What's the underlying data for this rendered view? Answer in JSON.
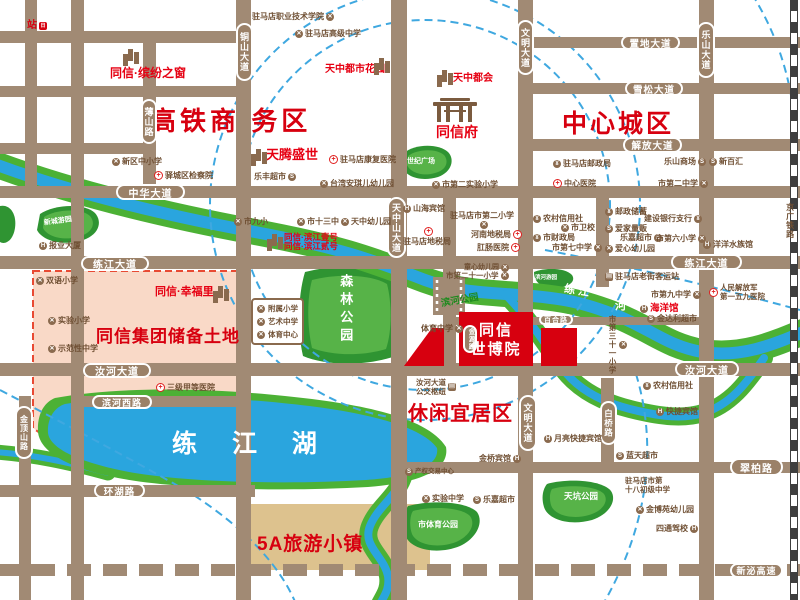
{
  "colors": {
    "road": "#a18a74",
    "capsule": "#9b8168",
    "red_accent": "#d7000f",
    "project_red": "#e60012",
    "park_green": "#2f9432",
    "park_green_light": "#57b348",
    "water_blue": "#2aa5de",
    "river_green": "#4cb135",
    "pink_zone": "#f9d9c7",
    "tan_block": "#ddc28e",
    "poi_brown": "#6f4f33",
    "arc_blue": "#3fa8e0"
  },
  "zones": [
    {
      "name": "zone-hsr-business",
      "text": "高铁商 务区",
      "x": 150,
      "y": 101,
      "size": 26,
      "ls": 4
    },
    {
      "name": "zone-central-city",
      "text": "中心城区",
      "x": 562,
      "y": 104,
      "size": 25,
      "ls": 3
    },
    {
      "name": "zone-reserve-land",
      "text": "同信集团储备土地",
      "x": 96,
      "y": 322,
      "size": 17,
      "ls": 1
    },
    {
      "name": "zone-leisure-area",
      "text": "休闲宜居区",
      "x": 408,
      "y": 397,
      "size": 20,
      "ls": 1
    },
    {
      "name": "zone-5a-town",
      "text": "5A旅游小镇",
      "x": 257,
      "y": 529,
      "size": 19,
      "ls": 1
    },
    {
      "name": "zone-lianjiang-lake",
      "text": "练 江 湖",
      "x": 172,
      "y": 424,
      "size": 25,
      "ls": 14,
      "color": "#ffffff"
    }
  ],
  "capsules": [
    {
      "name": "road-tongshan-avenue",
      "text": "铜山大道",
      "x": 236,
      "y": 23,
      "w": 17,
      "h": 58,
      "v": true,
      "size": 9
    },
    {
      "name": "road-boshan-road",
      "text": "薄山路",
      "x": 141,
      "y": 99,
      "w": 16,
      "h": 45,
      "v": true,
      "size": 9
    },
    {
      "name": "road-wenming-avenue-n",
      "text": "文明大道",
      "x": 517,
      "y": 20,
      "w": 17,
      "h": 55,
      "v": true,
      "size": 9
    },
    {
      "name": "road-leshan-avenue",
      "text": "乐山大道",
      "x": 697,
      "y": 22,
      "w": 18,
      "h": 56,
      "v": true,
      "size": 9
    },
    {
      "name": "road-zhidi-avenue",
      "text": "置地大道",
      "x": 621,
      "y": 35,
      "w": 59,
      "h": 15,
      "size": 9.5
    },
    {
      "name": "road-xuesong-avenue",
      "text": "雪松大道",
      "x": 625,
      "y": 81,
      "w": 58,
      "h": 15,
      "size": 9.5
    },
    {
      "name": "road-jiefang-avenue",
      "text": "解放大道",
      "x": 623,
      "y": 137,
      "w": 59,
      "h": 16,
      "size": 9.5
    },
    {
      "name": "road-zhonghua-avenue",
      "text": "中华大道",
      "x": 116,
      "y": 184,
      "w": 69,
      "h": 16,
      "size": 10
    },
    {
      "name": "road-lianjiang-avenue-w",
      "text": "练江大道",
      "x": 81,
      "y": 256,
      "w": 68,
      "h": 15,
      "size": 10
    },
    {
      "name": "road-lianjiang-avenue-e",
      "text": "练江大道",
      "x": 671,
      "y": 254,
      "w": 71,
      "h": 16,
      "size": 10
    },
    {
      "name": "road-tianzhongshan-avenue",
      "text": "天中山大道",
      "x": 387,
      "y": 197,
      "w": 19,
      "h": 61,
      "v": true,
      "size": 9
    },
    {
      "name": "road-ruhe-avenue-w",
      "text": "汝河大道",
      "x": 83,
      "y": 363,
      "w": 68,
      "h": 15,
      "size": 10
    },
    {
      "name": "road-ruhe-avenue-e",
      "text": "汝河大道",
      "x": 675,
      "y": 361,
      "w": 64,
      "h": 16,
      "size": 10
    },
    {
      "name": "road-binhe-west-road",
      "text": "滨河西路",
      "x": 92,
      "y": 395,
      "w": 60,
      "h": 14,
      "size": 9
    },
    {
      "name": "road-jindingshan-road",
      "text": "金顶山路",
      "x": 15,
      "y": 406,
      "w": 18,
      "h": 53,
      "v": true,
      "size": 8
    },
    {
      "name": "road-huanhu-road",
      "text": "环湖路",
      "x": 94,
      "y": 483,
      "w": 51,
      "h": 15,
      "size": 9.5
    },
    {
      "name": "road-wenming-avenue-s",
      "text": "文明大道",
      "x": 519,
      "y": 395,
      "w": 18,
      "h": 56,
      "v": true,
      "size": 9
    },
    {
      "name": "road-baiqiao-road",
      "text": "白桥路",
      "x": 600,
      "y": 401,
      "w": 17,
      "h": 44,
      "v": true,
      "size": 8.5
    },
    {
      "name": "road-cuibai-road",
      "text": "翠柏路",
      "x": 730,
      "y": 458,
      "w": 53,
      "h": 18,
      "size": 10
    },
    {
      "name": "road-xinmi-expressway",
      "text": "新泌高速",
      "x": 730,
      "y": 563,
      "w": 53,
      "h": 15,
      "size": 9
    },
    {
      "name": "road-baihe-road",
      "text": "百合路",
      "x": 539,
      "y": 314,
      "w": 34,
      "h": 11,
      "size": 7
    },
    {
      "name": "road-jinyuan-road",
      "text": "金源路",
      "x": 463,
      "y": 325,
      "w": 14,
      "h": 28,
      "v": true,
      "size": 6.5
    }
  ],
  "parklabels": [
    {
      "name": "park-century-square",
      "text": "世纪广场",
      "x": 407,
      "y": 158,
      "size": 7
    },
    {
      "name": "park-xincheng-garden",
      "text": "新城游园",
      "x": 44,
      "y": 218,
      "size": 7,
      "rot": -8
    },
    {
      "name": "park-forest-park",
      "text": "森林公园",
      "x": 338,
      "y": 274,
      "size": 13,
      "v": true,
      "ls": 5
    },
    {
      "name": "park-binhe-park",
      "text": "滨河公园",
      "x": 441,
      "y": 296,
      "size": 9.5,
      "rot": -10,
      "color": "#1e8a1e"
    },
    {
      "name": "park-binhe-garden",
      "text": "滨河游园",
      "x": 535,
      "y": 275,
      "size": 5.5
    },
    {
      "name": "park-city-sports-park",
      "text": "市体育公园",
      "x": 418,
      "y": 521,
      "size": 8
    },
    {
      "name": "park-tiankeng-park",
      "text": "天坑公园",
      "x": 564,
      "y": 492,
      "size": 8.5
    },
    {
      "name": "river-lianjiang",
      "text": "练  江",
      "x": 564,
      "y": 285,
      "size": 11,
      "rot": 9
    },
    {
      "name": "river-he",
      "text": "河",
      "x": 615,
      "y": 300,
      "size": 11
    }
  ],
  "projects": [
    {
      "name": "proj-binfenzhichuang",
      "text": "同信·缤纷之窗",
      "x": 110,
      "y": 67,
      "size": 12
    },
    {
      "name": "proj-tianzhong-city-garden",
      "text": "天中都市花园",
      "x": 325,
      "y": 64,
      "size": 10
    },
    {
      "name": "proj-tianzhong-duhui",
      "text": "天中都会",
      "x": 453,
      "y": 73,
      "size": 10
    },
    {
      "name": "proj-tongxin-fu",
      "text": "同信府",
      "x": 436,
      "y": 124,
      "size": 14
    },
    {
      "name": "proj-tianteng-shengshi",
      "text": "天腾盛世",
      "x": 266,
      "y": 148,
      "size": 13
    },
    {
      "name": "proj-binjiang-no1",
      "text": "同信·滨江壹号",
      "x": 284,
      "y": 233,
      "size": 8.5
    },
    {
      "name": "proj-binjiang-no2",
      "text": "同信·滨江贰号",
      "x": 284,
      "y": 242,
      "size": 8.5
    },
    {
      "name": "proj-xingfuli",
      "text": "同信·幸福里",
      "x": 155,
      "y": 286,
      "size": 11
    }
  ],
  "pois": [
    {
      "name": "poi-hsr-station",
      "text": "站",
      "icon": "train",
      "iconAfter": true,
      "x": 27,
      "y": 20,
      "size": 10,
      "color": "#d7000f"
    },
    {
      "name": "poi-xinqu-school",
      "text": "新区中小学",
      "icon": "school",
      "x": 112,
      "y": 157
    },
    {
      "name": "poi-yicheng-procuratorate",
      "text": "驿城区检察院",
      "icon": "red",
      "x": 154,
      "y": 171
    },
    {
      "name": "poi-vocational-college",
      "text": "驻马店职业技术学院",
      "icon": "school",
      "iconAfter": true,
      "x": 252,
      "y": 12
    },
    {
      "name": "poi-senior-high",
      "text": "驻马店高级中学",
      "icon": "school",
      "x": 295,
      "y": 29
    },
    {
      "name": "poi-rehab-hospital",
      "text": "驻马店康复医院",
      "icon": "red",
      "x": 329,
      "y": 155
    },
    {
      "name": "poi-lefeng-market",
      "text": "乐丰超市",
      "icon": "shop",
      "iconAfter": true,
      "x": 254,
      "y": 172
    },
    {
      "name": "poi-taiwan-kindergarten",
      "text": "台湾安琪儿幼儿园",
      "icon": "school",
      "x": 320,
      "y": 179
    },
    {
      "name": "poi-no2-experimental-primary",
      "text": "市第二实验小学",
      "icon": "school",
      "x": 432,
      "y": 180
    },
    {
      "name": "poi-post-office",
      "text": "驻马店邮政局",
      "icon": "bank",
      "x": 553,
      "y": 159
    },
    {
      "name": "poi-central-hospital",
      "text": "中心医院",
      "icon": "red",
      "x": 553,
      "y": 179
    },
    {
      "name": "poi-leshan-mall",
      "text": "乐山商场",
      "icon": "shop",
      "iconAfter": true,
      "x": 664,
      "y": 157
    },
    {
      "name": "poi-xinbaihui",
      "text": "新百汇",
      "icon": "shop",
      "x": 709,
      "y": 157
    },
    {
      "name": "poi-no2-middle-school",
      "text": "市第二中学",
      "icon": "school",
      "iconAfter": true,
      "x": 658,
      "y": 179
    },
    {
      "name": "poi-shanhai-hotel",
      "text": "山海宾馆",
      "icon": "hotel",
      "x": 403,
      "y": 204
    },
    {
      "name": "poi-no2-primary",
      "text": "驻马店市第二小学",
      "x": 450,
      "y": 211
    },
    {
      "name": "poi-no2-primary-icon",
      "text": "",
      "icon": "school",
      "x": 480,
      "y": 221
    },
    {
      "name": "poi-city-tax-bureau",
      "text": "驻马店地税局",
      "x": 403,
      "y": 237
    },
    {
      "name": "poi-city-tax-icon",
      "text": "",
      "icon": "red",
      "x": 424,
      "y": 227
    },
    {
      "name": "poi-henan-tax",
      "text": "河南地税局",
      "icon": "red",
      "iconAfter": true,
      "x": 471,
      "y": 230
    },
    {
      "name": "poi-gangchang-hospital",
      "text": "肛肠医院",
      "icon": "red",
      "iconAfter": true,
      "x": 477,
      "y": 243
    },
    {
      "name": "poi-rural-credit-n",
      "text": "农村信用社",
      "icon": "bank",
      "x": 533,
      "y": 214
    },
    {
      "name": "poi-health-school",
      "text": "市卫校",
      "icon": "school",
      "x": 561,
      "y": 223
    },
    {
      "name": "poi-finance-bureau",
      "text": "市财政局",
      "icon": "bank",
      "x": 533,
      "y": 233
    },
    {
      "name": "poi-no7-middle",
      "text": "市第七中学",
      "icon": "school",
      "iconAfter": true,
      "x": 552,
      "y": 243
    },
    {
      "name": "poi-postal-savings",
      "text": "邮政储蓄",
      "icon": "bank",
      "x": 605,
      "y": 207
    },
    {
      "name": "poi-ccb-branch",
      "text": "建设银行支行",
      "icon": "bank",
      "iconAfter": true,
      "x": 644,
      "y": 214
    },
    {
      "name": "poi-aijia-store",
      "text": "爱家量贩",
      "icon": "shop",
      "x": 605,
      "y": 224
    },
    {
      "name": "poi-lejia-market-n",
      "text": "乐嘉超市",
      "icon": "shop",
      "iconAfter": true,
      "x": 620,
      "y": 233
    },
    {
      "name": "poi-no6-primary",
      "text": "市第六小学",
      "icon": "school",
      "iconAfter": true,
      "x": 656,
      "y": 234
    },
    {
      "name": "poi-aixin-kindergarten",
      "text": "爱心幼儿园",
      "icon": "school",
      "x": 605,
      "y": 244
    },
    {
      "name": "poi-yangyang-aquarium",
      "text": "洋洋水族馆",
      "icon": "hotel",
      "x": 703,
      "y": 240
    },
    {
      "name": "poi-no9-primary",
      "text": "市九小",
      "icon": "school",
      "x": 234,
      "y": 217
    },
    {
      "name": "poi-no13-middle",
      "text": "市十三中",
      "icon": "school",
      "x": 297,
      "y": 217
    },
    {
      "name": "poi-tianzhong-kindergarten",
      "text": "天中幼儿园",
      "icon": "school",
      "x": 341,
      "y": 217
    },
    {
      "name": "poi-press-building",
      "text": "报业大厦",
      "icon": "hotel",
      "x": 39,
      "y": 241
    },
    {
      "name": "poi-bilingual-primary",
      "text": "双语小学",
      "icon": "school",
      "x": 36,
      "y": 276
    },
    {
      "name": "poi-experimental-primary",
      "text": "实验小学",
      "icon": "school",
      "x": 48,
      "y": 316
    },
    {
      "name": "poi-model-middle",
      "text": "示范性中学",
      "icon": "school",
      "x": 48,
      "y": 344
    },
    {
      "name": "poi-3a-hospital",
      "text": "三级甲等医院",
      "icon": "red",
      "x": 156,
      "y": 383
    },
    {
      "name": "poi-tongxin-kindergarten",
      "text": "童心幼儿园",
      "icon": "school",
      "iconAfter": true,
      "x": 464,
      "y": 264,
      "size": 7
    },
    {
      "name": "poi-no21-primary",
      "text": "市第二十一小学",
      "icon": "school",
      "iconAfter": true,
      "x": 446,
      "y": 271,
      "size": 7.5
    },
    {
      "name": "poi-sports-middle",
      "text": "体育中学",
      "icon": "school",
      "iconAfter": true,
      "x": 421,
      "y": 324
    },
    {
      "name": "poi-no31-primary",
      "text": "市第三十一小学",
      "icon": "school",
      "x": 608,
      "y": 315,
      "v": true,
      "size": 7.5
    },
    {
      "name": "poi-laojie-bus-station",
      "text": "驻马店老街客运站",
      "icon": "bus",
      "x": 605,
      "y": 272
    },
    {
      "name": "poi-no9-middle",
      "text": "市第九中学",
      "icon": "school",
      "iconAfter": true,
      "x": 651,
      "y": 290
    },
    {
      "name": "poi-ocean-hall",
      "text": "海洋馆",
      "icon": "hotel",
      "x": 640,
      "y": 303,
      "size": 9.5,
      "color": "#e60012"
    },
    {
      "name": "poi-jindali-market",
      "text": "金达利超市",
      "icon": "shop",
      "x": 647,
      "y": 314
    },
    {
      "name": "poi-pla-159-hospital",
      "lines": [
        "人民解放军",
        "第一五九医院"
      ],
      "icon": "red",
      "x": 709,
      "y": 283,
      "size": 7.5
    },
    {
      "name": "poi-bus-hub",
      "lines": [
        "汝河大道",
        "公交枢纽"
      ],
      "icon": "bus",
      "iconAfter": true,
      "x": 416,
      "y": 378,
      "size": 7.5
    },
    {
      "name": "poi-moon-hotel",
      "text": "月亮快捷宾馆",
      "icon": "hotel",
      "x": 544,
      "y": 434
    },
    {
      "name": "poi-jinqiao-hotel",
      "text": "金桥宾馆",
      "icon": "hotel",
      "iconAfter": true,
      "x": 479,
      "y": 454
    },
    {
      "name": "poi-rural-credit-s",
      "text": "农村信用社",
      "icon": "bank",
      "x": 643,
      "y": 381
    },
    {
      "name": "poi-express-hotel",
      "text": "快捷宾馆",
      "icon": "hotel",
      "x": 656,
      "y": 407
    },
    {
      "name": "poi-lantian-market",
      "text": "蓝天超市",
      "icon": "shop",
      "x": 616,
      "y": 451
    },
    {
      "name": "poi-no18-junior",
      "lines": [
        "驻马店市第",
        "十八初级中学"
      ],
      "x": 625,
      "y": 476,
      "size": 7.5
    },
    {
      "name": "poi-jinboyuan-kindergarten",
      "text": "金博苑幼儿园",
      "icon": "school",
      "x": 636,
      "y": 505
    },
    {
      "name": "poi-sitong-driving-school",
      "text": "四通驾校",
      "icon": "hotel",
      "iconAfter": true,
      "x": 656,
      "y": 524
    },
    {
      "name": "poi-experimental-middle",
      "text": "实验中学",
      "icon": "school",
      "x": 422,
      "y": 494
    },
    {
      "name": "poi-lejia-market-s",
      "text": "乐嘉超市",
      "icon": "shop",
      "x": 473,
      "y": 495
    },
    {
      "name": "poi-property-exchange",
      "text": "产权交易中心",
      "icon": "shop",
      "x": 405,
      "y": 468,
      "size": 6.5
    },
    {
      "name": "poi-jingguang-railway",
      "text": "京广铁路",
      "x": 785,
      "y": 203,
      "v": true,
      "size": 8
    },
    {
      "name": "icon-binfenzhichuang",
      "text": "",
      "icon": "building",
      "x": 122,
      "y": 49
    },
    {
      "name": "icon-tianzhong-garden",
      "text": "",
      "icon": "building",
      "x": 373,
      "y": 58
    },
    {
      "name": "icon-tianzhong-duhui",
      "text": "",
      "icon": "building",
      "x": 436,
      "y": 70
    },
    {
      "name": "icon-tianteng",
      "text": "",
      "icon": "building",
      "x": 250,
      "y": 149
    },
    {
      "name": "icon-xingfuli",
      "text": "",
      "icon": "building",
      "x": 212,
      "y": 286
    },
    {
      "name": "icon-binjiang",
      "text": "",
      "icon": "building",
      "x": 266,
      "y": 234
    },
    {
      "name": "icon-tongxinfu-gate",
      "text": "",
      "icon": "gate",
      "x": 432,
      "y": 98
    }
  ],
  "special": {
    "shiboyuan": {
      "name": "label-shiboyuan",
      "lines": [
        "同信",
        "世博院"
      ],
      "x": 458,
      "y": 322,
      "w": 76,
      "size": 15
    },
    "schoolbox": {
      "name": "schools-box",
      "x": 251,
      "y": 298,
      "items": [
        "附属小学",
        "艺术中学",
        "体育中心"
      ]
    }
  }
}
